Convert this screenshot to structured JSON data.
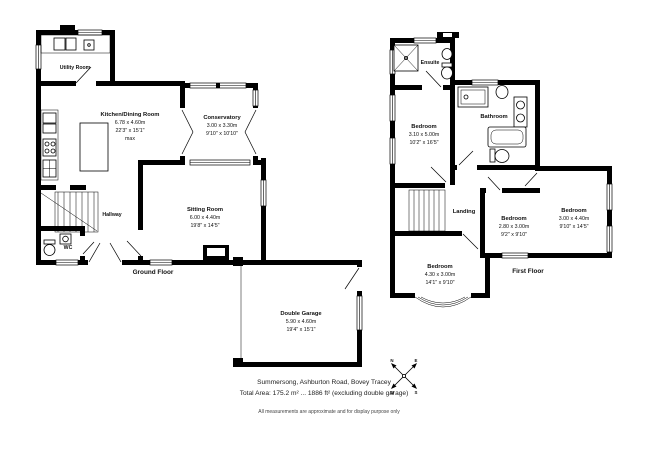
{
  "ground_floor": {
    "title": "Ground Floor",
    "rooms": {
      "utility": {
        "name": "Utility Room"
      },
      "kitchen": {
        "name": "Kitchen/Dining Room",
        "metric": "6.78 x 4.60m",
        "imperial": "22'3\" x 15'1\"",
        "note": "max"
      },
      "conservatory": {
        "name": "Conservatory",
        "metric": "3.00 x 3.30m",
        "imperial": "9'10\" x 10'10\""
      },
      "sitting_room": {
        "name": "Sitting Room",
        "metric": "6.00 x 4.40m",
        "imperial": "19'8\" x 14'5\""
      },
      "hallway": {
        "name": "Hallway"
      },
      "wc": {
        "name": "WC"
      },
      "double_garage": {
        "name": "Double Garage",
        "metric": "5.90 x 4.60m",
        "imperial": "19'4\" x 15'1\""
      }
    }
  },
  "first_floor": {
    "title": "First Floor",
    "rooms": {
      "ensuite": {
        "name": "Ensuite"
      },
      "bedroom_master": {
        "name": "Bedroom",
        "metric": "3.10 x 5.00m",
        "imperial": "10'2\" x 16'5\""
      },
      "bathroom": {
        "name": "Bathroom"
      },
      "landing": {
        "name": "Landing"
      },
      "bedroom_middle": {
        "name": "Bedroom",
        "metric": "2.80 x 3.00m",
        "imperial": "9'2\" x 9'10\""
      },
      "bedroom_right": {
        "name": "Bedroom",
        "metric": "3.00 x 4.40m",
        "imperial": "9'10\" x 14'5\""
      },
      "bedroom_front": {
        "name": "Bedroom",
        "metric": "4.30 x 3.00m",
        "imperial": "14'1\" x 9'10\""
      }
    }
  },
  "footer": {
    "address": "Summersong, Ashburton Road, Bovey Tracey",
    "total_area": "Total Area: 175.2 m² ... 1886 ft² (excluding double garage)",
    "disclaimer": "All measurements are approximate and for display purpose only"
  },
  "compass": {
    "north": "N",
    "east": "E",
    "south": "S",
    "west": "W"
  },
  "colors": {
    "wall": "#000000",
    "background": "#ffffff",
    "text": "#111111"
  }
}
